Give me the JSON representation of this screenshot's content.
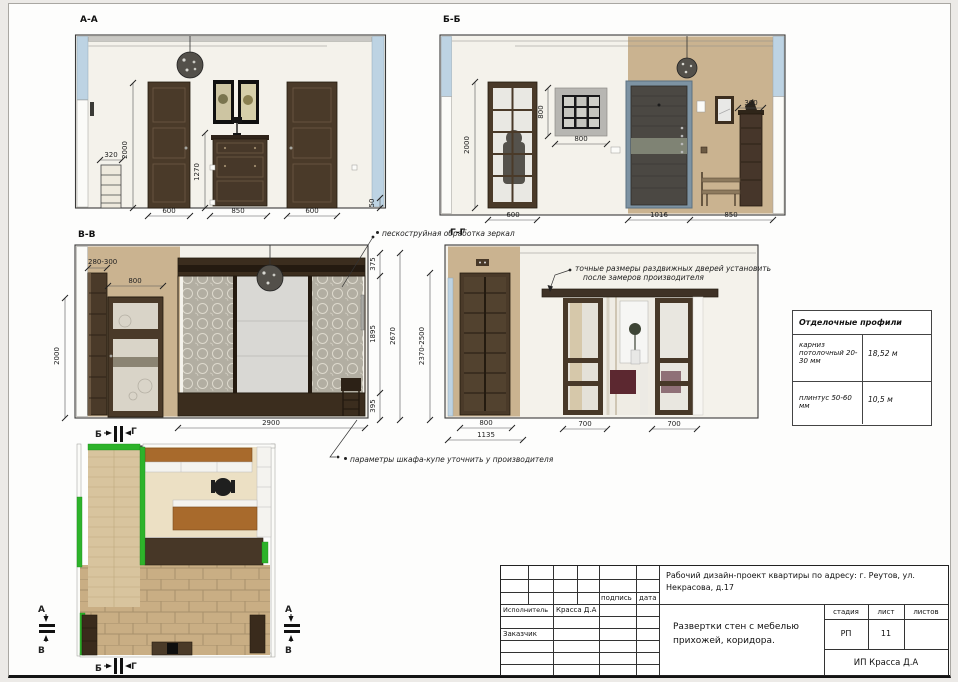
{
  "colors": {
    "accent_green": "#2db32a",
    "wall_beige": "#cab390",
    "door_brown": "#4a3a29",
    "wall_cut_blue": "#bdd3e3"
  },
  "elevations": {
    "aa": {
      "title": "А-А",
      "dims": {
        "w320": "320",
        "h2000": "2000",
        "h1270": "1270",
        "w600l": "600",
        "w850": "850",
        "w600r": "600",
        "h50": "50"
      }
    },
    "bb": {
      "title": "Б-Б",
      "dims": {
        "h2000": "2000",
        "h800": "800",
        "w800": "800",
        "w300": "300",
        "w600": "600",
        "w1016": "1016",
        "w850": "850"
      }
    },
    "vv": {
      "title": "В-В",
      "dims": {
        "w280_300": "280-300",
        "w800": "800",
        "h2000": "2000",
        "h375": "375",
        "h1895": "1895",
        "h395": "395",
        "h2670": "2670",
        "w2900": "2900"
      },
      "note_mirrors": "пескоструйная обработка зеркал",
      "note_wardrobe": "параметры шкафа-купе уточнить у производителя",
      "marker_b": "Б",
      "marker_g": "Г"
    },
    "gg": {
      "title": "Г-Г",
      "dims": {
        "h2370_2500": "2370-2500",
        "w800": "800",
        "w1135": "1135",
        "w700l": "700",
        "w700r": "700"
      },
      "note_doors_line1": "точные размеры раздвижных дверей установить",
      "note_doors_line2": "после замеров производителя"
    }
  },
  "plan": {
    "marker_b_top": "Б",
    "marker_g_top": "Г",
    "marker_b_bottom": "Б",
    "marker_g_bottom": "Г",
    "marker_a_left": "А",
    "marker_v_left": "В",
    "marker_a_right": "А",
    "marker_v_right": "В"
  },
  "profiles_table": {
    "title": "Отделочные профили",
    "rows": [
      {
        "name": "карниз потолочный 20-30 мм",
        "value": "18,52 м"
      },
      {
        "name": "плинтус 50-60 мм",
        "value": "10,5 м"
      }
    ]
  },
  "title_block": {
    "project": "Рабочий дизайн-проект квартиры по адресу: г. Реутов, ул. Некрасова, д.17",
    "signature_label": "подпись",
    "date_label": "дата",
    "executor_label": "Исполнитель",
    "executor_name": "Красса Д.А",
    "client_label": "Заказчик",
    "sheet_title_line1": "Развертки стен с мебелью",
    "sheet_title_line2": "прихожей, коридора.",
    "stage_label": "стадия",
    "sheet_label": "лист",
    "sheets_label": "листов",
    "stage_value": "РП",
    "sheet_value": "11",
    "company": "ИП Красса Д.А"
  }
}
